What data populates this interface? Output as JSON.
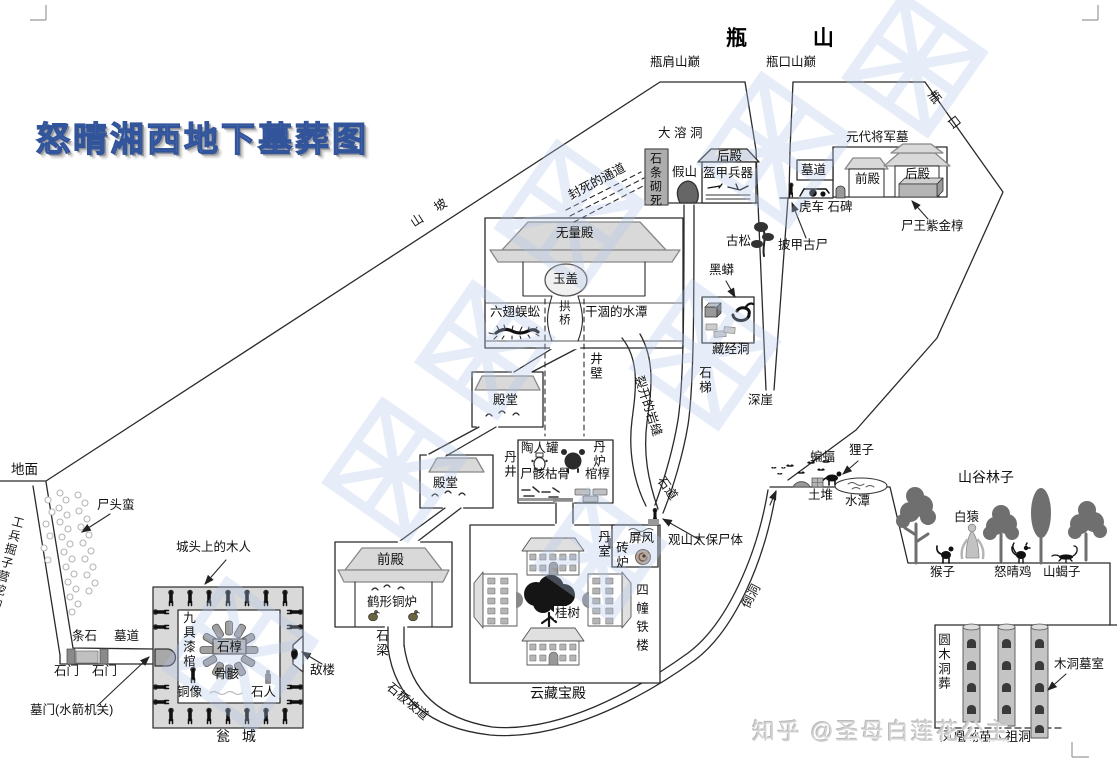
{
  "header": {
    "logo_title": "怒晴湘西地下墓葬图",
    "mountain_title": "瓶 山"
  },
  "watermark": {
    "zhihu": "知乎 @圣母白莲花公主"
  },
  "accent_colors": {
    "logo_blue": "#7087c3",
    "watermark_blue": "#afc6e8",
    "line_black": "#2a2a2a"
  },
  "labels": [
    {
      "name": "label-ping-jian-summit",
      "text": "瓶肩山巅",
      "x": 650,
      "y": 55
    },
    {
      "name": "label-ping-kou-summit",
      "text": "瓶口山巅",
      "x": 766,
      "y": 55
    },
    {
      "name": "label-pingkou-slope",
      "text": "瓶 口",
      "x": 936,
      "y": 88,
      "rot": 52,
      "ls": 8
    },
    {
      "name": "label-da-rong-dong",
      "text": "大 溶 洞",
      "x": 658,
      "y": 126
    },
    {
      "name": "label-shitiao-qisi",
      "text": "石条砌死",
      "x": 648,
      "y": 152,
      "v": 1,
      "size": 12
    },
    {
      "name": "label-jiashan",
      "text": "假山",
      "x": 672,
      "y": 165
    },
    {
      "name": "label-houdian-cave",
      "text": "后殿",
      "x": 717,
      "y": 149
    },
    {
      "name": "label-kuijia-bingqi",
      "text": "盔甲兵器",
      "x": 703,
      "y": 166
    },
    {
      "name": "label-fengsi-tongdao",
      "text": "封死的通道",
      "x": 566,
      "y": 190,
      "rot": -28
    },
    {
      "name": "label-shanpo",
      "text": "山 坡",
      "x": 408,
      "y": 218,
      "rot": -33,
      "ls": 6
    },
    {
      "name": "label-yuandai-tomb",
      "text": "元代将军墓",
      "x": 846,
      "y": 130
    },
    {
      "name": "label-mudao-top",
      "text": "墓道",
      "x": 801,
      "y": 163
    },
    {
      "name": "label-qiandian-top",
      "text": "前殿",
      "x": 855,
      "y": 172
    },
    {
      "name": "label-houdian-top",
      "text": "后殿",
      "x": 905,
      "y": 167
    },
    {
      "name": "label-huche-shibei",
      "text": "虎车 石碑",
      "x": 799,
      "y": 200
    },
    {
      "name": "label-shiwang-zijinchun",
      "text": "尸王紫金椁",
      "x": 901,
      "y": 219
    },
    {
      "name": "label-pijia-gushi",
      "text": "披甲古尸",
      "x": 778,
      "y": 238
    },
    {
      "name": "label-gusong",
      "text": "古松",
      "x": 726,
      "y": 234
    },
    {
      "name": "label-heimang",
      "text": "黑蟒",
      "x": 709,
      "y": 263
    },
    {
      "name": "label-cangjingdong",
      "text": "藏经洞",
      "x": 712,
      "y": 342
    },
    {
      "name": "label-shiti",
      "text": "石梯",
      "x": 697,
      "y": 366,
      "v": 1
    },
    {
      "name": "label-shenya",
      "text": "深崖",
      "x": 748,
      "y": 393
    },
    {
      "name": "label-wuliangdian",
      "text": "无量殿",
      "x": 556,
      "y": 226
    },
    {
      "name": "label-yugai",
      "text": "玉盖",
      "x": 553,
      "y": 272
    },
    {
      "name": "label-liuchi-wugong",
      "text": "六翅蜈蚣",
      "x": 490,
      "y": 305
    },
    {
      "name": "label-gongqiao",
      "text": "拱桥",
      "x": 557,
      "y": 300,
      "v": 1,
      "size": 11.5
    },
    {
      "name": "label-ganhe-shuitan",
      "text": "干涸的水潭",
      "x": 585,
      "y": 305
    },
    {
      "name": "label-jingbi",
      "text": "井壁",
      "x": 588,
      "y": 352,
      "v": 1
    },
    {
      "name": "label-diantang-1",
      "text": "殿堂",
      "x": 493,
      "y": 393
    },
    {
      "name": "label-diantang-2",
      "text": "殿堂",
      "x": 433,
      "y": 476
    },
    {
      "name": "label-danjing",
      "text": "丹井",
      "x": 502,
      "y": 450,
      "v": 1
    },
    {
      "name": "label-taorenguang",
      "text": "陶人罐",
      "x": 521,
      "y": 441
    },
    {
      "name": "label-danlu",
      "text": "丹炉",
      "x": 591,
      "y": 440,
      "v": 1
    },
    {
      "name": "label-shihai-kugu",
      "text": "尸骸枯骨",
      "x": 520,
      "y": 467
    },
    {
      "name": "label-guanchun",
      "text": "棺椁",
      "x": 585,
      "y": 467
    },
    {
      "name": "label-liekai-yanfeng",
      "text": "裂开的岩缝",
      "x": 645,
      "y": 374,
      "rot": 72
    },
    {
      "name": "label-shidao",
      "text": "石道",
      "x": 666,
      "y": 474,
      "rot": 55
    },
    {
      "name": "label-guanshan-taibao",
      "text": "观山太保尸体",
      "x": 668,
      "y": 533
    },
    {
      "name": "label-danshi",
      "text": "丹室",
      "x": 596,
      "y": 530,
      "v": 1
    },
    {
      "name": "label-zhuanlu",
      "text": "砖炉",
      "x": 614,
      "y": 541,
      "v": 1
    },
    {
      "name": "label-pingfeng",
      "text": "屏风",
      "x": 629,
      "y": 531
    },
    {
      "name": "label-sichuang-tielou",
      "text": "四幢铁楼",
      "x": 634,
      "y": 583,
      "v": 1,
      "ls": 6
    },
    {
      "name": "label-guishu",
      "text": "桂树",
      "x": 554,
      "y": 606,
      "bg": 1
    },
    {
      "name": "label-yuncang-baodian",
      "text": "云藏宝殿",
      "x": 530,
      "y": 686,
      "size": 14
    },
    {
      "name": "label-qiandian-main",
      "text": "前殿",
      "x": 377,
      "y": 552,
      "size": 13.5
    },
    {
      "name": "label-hexing-tonglu",
      "text": "鹤形铜炉",
      "x": 367,
      "y": 595
    },
    {
      "name": "label-shiliang",
      "text": "石梁",
      "x": 374,
      "y": 629,
      "v": 1
    },
    {
      "name": "label-shiban-podao",
      "text": "石板坡道",
      "x": 393,
      "y": 680,
      "rot": 40
    },
    {
      "name": "label-daodong",
      "text": "倒洞",
      "x": 739,
      "y": 604,
      "rot": -62
    },
    {
      "name": "label-chengtou-muren",
      "text": "城头上的木人",
      "x": 176,
      "y": 540
    },
    {
      "name": "label-jiuju-qiguan",
      "text": "九具漆棺",
      "x": 181,
      "y": 611,
      "v": 1
    },
    {
      "name": "label-shichun",
      "text": "石椁",
      "x": 217,
      "y": 640
    },
    {
      "name": "label-gubai",
      "text": "骨骸",
      "x": 214,
      "y": 667
    },
    {
      "name": "label-tongxiang",
      "text": "铜像",
      "x": 177,
      "y": 685
    },
    {
      "name": "label-shiren",
      "text": "石人",
      "x": 251,
      "y": 685
    },
    {
      "name": "label-dilou",
      "text": "敌楼",
      "x": 310,
      "y": 663
    },
    {
      "name": "label-wengcheng",
      "text": "瓮 城",
      "x": 216,
      "y": 729,
      "size": 14,
      "ls": 4
    },
    {
      "name": "label-tiaoshi",
      "text": "条石",
      "x": 72,
      "y": 629
    },
    {
      "name": "label-mudao-left",
      "text": "墓道",
      "x": 114,
      "y": 629
    },
    {
      "name": "label-shimen-1",
      "text": "石门",
      "x": 54,
      "y": 664
    },
    {
      "name": "label-shimen-2",
      "text": "石门",
      "x": 92,
      "y": 664
    },
    {
      "name": "label-mumen",
      "text": "墓门(水箭机关)",
      "x": 30,
      "y": 703
    },
    {
      "name": "label-dimian",
      "text": "地面",
      "x": 11,
      "y": 462,
      "size": 13.5
    },
    {
      "name": "label-shitouman",
      "text": "尸头蛮",
      "x": 97,
      "y": 498
    },
    {
      "name": "label-gongbing-didao",
      "text": "工兵掘子营挖的地道",
      "x": 12,
      "y": 514,
      "v": 1,
      "rot": 15,
      "size": 12
    },
    {
      "name": "label-bianfu",
      "text": "蝙蝠",
      "x": 810,
      "y": 450
    },
    {
      "name": "label-lizi",
      "text": "狸子",
      "x": 849,
      "y": 443
    },
    {
      "name": "label-tudui",
      "text": "土堆",
      "x": 808,
      "y": 488
    },
    {
      "name": "label-shuitan",
      "text": "水潭",
      "x": 845,
      "y": 494
    },
    {
      "name": "label-shangu-linzi",
      "text": "山谷林子",
      "x": 958,
      "y": 470,
      "size": 14
    },
    {
      "name": "label-baiyuan",
      "text": "白猿",
      "x": 954,
      "y": 510
    },
    {
      "name": "label-houzi",
      "text": "猴子",
      "x": 930,
      "y": 565
    },
    {
      "name": "label-nuqingji",
      "text": "怒晴鸡",
      "x": 994,
      "y": 565
    },
    {
      "name": "label-shanxiezi",
      "text": "山蝎子",
      "x": 1043,
      "y": 565
    },
    {
      "name": "label-yuanmu-dongzang",
      "text": "圆木洞葬",
      "x": 936,
      "y": 633,
      "v": 1
    },
    {
      "name": "label-mudong-mushi",
      "text": "木洞墓室",
      "x": 1054,
      "y": 657
    },
    {
      "name": "label-fenghuang-ao",
      "text": "凤凰坳苗人祖洞",
      "x": 940,
      "y": 730,
      "size": 13
    }
  ]
}
